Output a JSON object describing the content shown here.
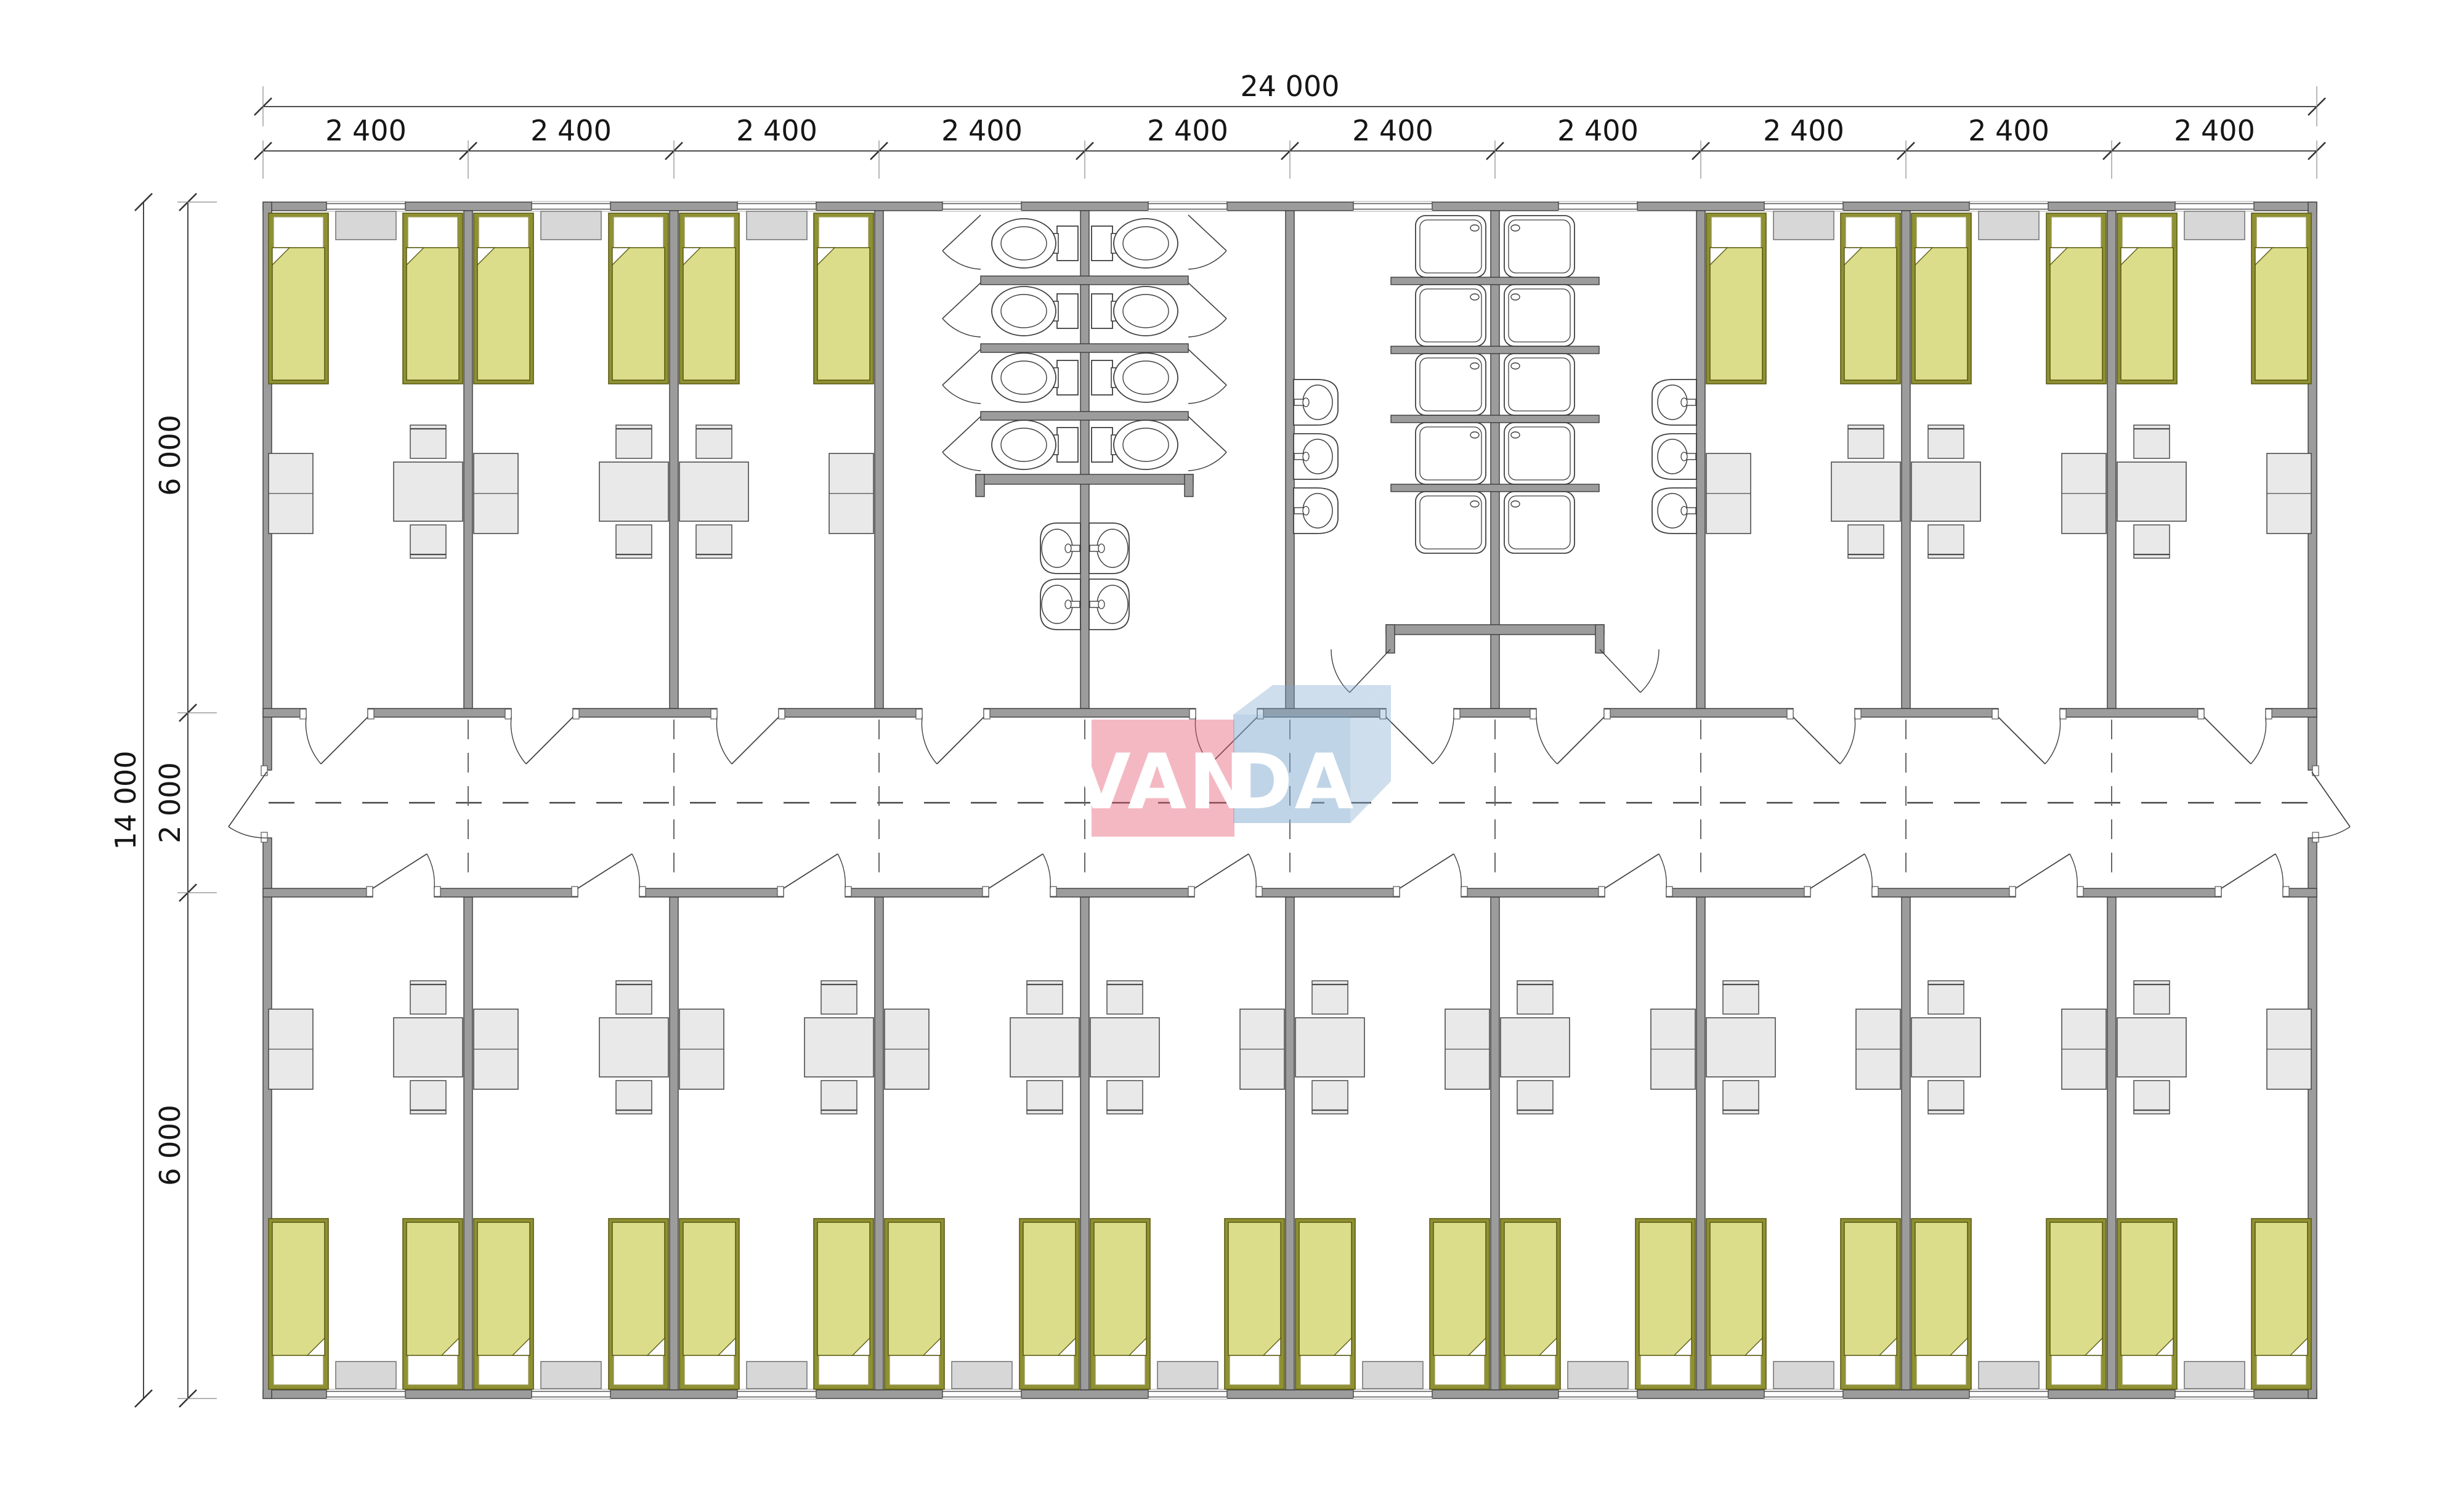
{
  "logo": {
    "van": "VAN",
    "da": "DA"
  },
  "dimensions": {
    "total_width_label": "24 000",
    "module_width_labels": [
      "2 400",
      "2 400",
      "2 400",
      "2 400",
      "2 400",
      "2 400",
      "2 400",
      "2 400",
      "2 400",
      "2 400"
    ],
    "total_height_label": "14 000",
    "height_segment_labels": [
      "6 000",
      "2 000",
      "6 000"
    ]
  },
  "colors": {
    "wall": "#9c9c9c",
    "wall_stroke": "#3d3d3d",
    "bed_frame": "#8f9032",
    "bed_frame_stroke": "#5c5c15",
    "bed_blanket": "#dcdd8a",
    "pillow": "#ffffff",
    "furniture_fill": "#e9e9e9",
    "furniture_stroke": "#4d4d4d",
    "radiator_fill": "#d7d7d7",
    "radiator_stroke": "#787878",
    "fixture_stroke": "#3f3f3f",
    "dash": "#555555",
    "dimension_ink": "#161616",
    "logo_red": "#e4556e",
    "logo_blue": "#7fa9cd",
    "logo_text": "#ffffff"
  },
  "counts": {
    "modules": 10,
    "rooms_top_band": 6,
    "rooms_bottom_band": 10,
    "beds": 32,
    "toilets": 8,
    "wash_basins": 10,
    "shower_trays": 10
  }
}
